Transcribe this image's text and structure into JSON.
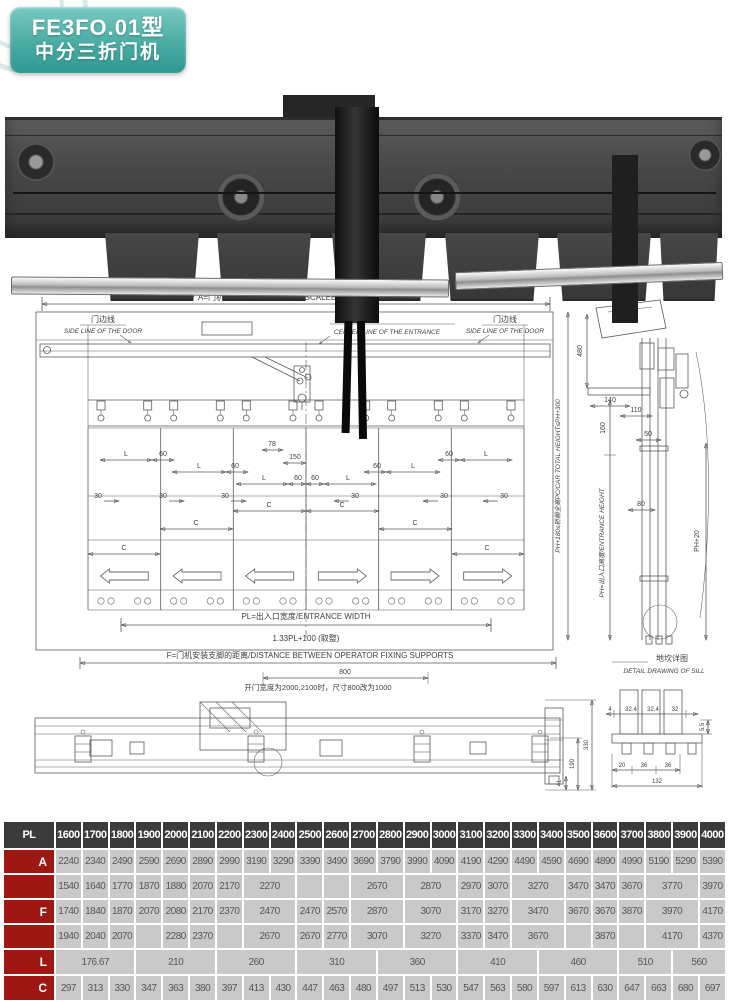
{
  "badge": {
    "model": "FE3FO.01型",
    "name": "中分三折门机"
  },
  "drawing_main": {
    "a_label": "A=门机底板长度/OPERATOR  SCALEBOARD  LENGHT",
    "side_line_cn": "门边线",
    "side_line_en": "SIDE LINE OF THE DOOR",
    "center_cn": "出入口中心",
    "center_en": "CENTER LINE OF THE ENTRANCE",
    "dims": {
      "L": "L",
      "d60": "60",
      "d30": "30",
      "C": "C",
      "d78": "78",
      "d150": "150"
    },
    "pl_label": "PL=出入口宽度/ENTRANCE WIDTH",
    "pl_formula": "1.33PL+100 (取整)"
  },
  "drawing_section": {
    "d480": "480",
    "d140": "140",
    "d160": "160",
    "d110": "110",
    "d50": "50",
    "d80": "80",
    "ph20": "PH+20",
    "car_height": "PH+180≤轿厢全高PC/CAR  TOTAL  HEIGHT≤PH+300",
    "entrance_height": "PH=出入口高度/ENTRANCE  HEIGHT"
  },
  "drawing_bottom": {
    "f_label": "F=门机安装支脚的距离/DISTANCE  BETWEEN  OPERATOR  FIXING  SUPPORTS",
    "d800": "800",
    "note": "开门宽度为2000,2100时，尺寸800改为1000",
    "d330": "330",
    "d190": "190",
    "d41": "41"
  },
  "sill_detail": {
    "title_cn": "地坎详图",
    "title_en": "DETAIL DRAWING  OF  SILL",
    "dims_top": [
      "4",
      "32.4",
      "32.4",
      "32"
    ],
    "d55": "5.5",
    "dims_bottom": [
      "20",
      "36",
      "36"
    ],
    "d132": "132"
  },
  "table": {
    "header_label": "PL",
    "columns": [
      "1600",
      "1700",
      "1800",
      "1900",
      "2000",
      "2100",
      "2200",
      "2300",
      "2400",
      "2500",
      "2600",
      "2700",
      "2800",
      "2900",
      "3000",
      "3100",
      "3200",
      "3300",
      "3400",
      "3500",
      "3600",
      "3700",
      "3800",
      "3900",
      "4000"
    ],
    "row_a": {
      "label": "A",
      "values": [
        "2240",
        "2340",
        "2490",
        "2590",
        "2690",
        "2890",
        "2990",
        "3190",
        "3290",
        "3390",
        "3490",
        "3690",
        "3790",
        "3990",
        "4090",
        "4190",
        "4290",
        "4490",
        "4590",
        "4690",
        "4890",
        "4990",
        "5190",
        "5290",
        "5390"
      ]
    },
    "row_f": {
      "label": "F",
      "subrows": [
        [
          "1540",
          "1640",
          "1770",
          "1870",
          "1880",
          "2070",
          "2170",
          {
            "v": "2270",
            "s": 2
          },
          "",
          "",
          {
            "v": "2670",
            "s": 2
          },
          {
            "v": "2870",
            "s": 2
          },
          "2970",
          "3070",
          {
            "v": "3270",
            "s": 2
          },
          "3470",
          "3470",
          "3670",
          {
            "v": "3770",
            "s": 2
          },
          "3970"
        ],
        [
          "1740",
          "1840",
          "1870",
          "2070",
          "2080",
          "2170",
          "2370",
          {
            "v": "2470",
            "s": 2
          },
          "2470",
          "2570",
          {
            "v": "2870",
            "s": 2
          },
          {
            "v": "3070",
            "s": 2
          },
          "3170",
          "3270",
          {
            "v": "3470",
            "s": 2
          },
          "3670",
          "3670",
          "3870",
          {
            "v": "3970",
            "s": 2
          },
          "4170"
        ],
        [
          "1940",
          "2040",
          "2070",
          "",
          "2280",
          "2370",
          "",
          {
            "v": "2670",
            "s": 2
          },
          "2670",
          "2770",
          {
            "v": "3070",
            "s": 2
          },
          {
            "v": "3270",
            "s": 2
          },
          "3370",
          "3470",
          {
            "v": "3670",
            "s": 2
          },
          "",
          "3870",
          "",
          {
            "v": "4170",
            "s": 2
          },
          "4370"
        ]
      ]
    },
    "row_l": {
      "label": "L",
      "cells": [
        {
          "v": "176.67",
          "s": 3
        },
        {
          "v": "210",
          "s": 3
        },
        {
          "v": "260",
          "s": 3
        },
        {
          "v": "310",
          "s": 3
        },
        {
          "v": "360",
          "s": 3
        },
        {
          "v": "410",
          "s": 3
        },
        {
          "v": "460",
          "s": 3
        },
        {
          "v": "510",
          "s": 2
        },
        {
          "v": "560",
          "s": 2
        }
      ]
    },
    "row_c": {
      "label": "C",
      "values": [
        "297",
        "313",
        "330",
        "347",
        "363",
        "380",
        "397",
        "413",
        "430",
        "447",
        "463",
        "480",
        "497",
        "513",
        "530",
        "547",
        "563",
        "580",
        "597",
        "613",
        "630",
        "647",
        "663",
        "680",
        "697"
      ]
    }
  }
}
